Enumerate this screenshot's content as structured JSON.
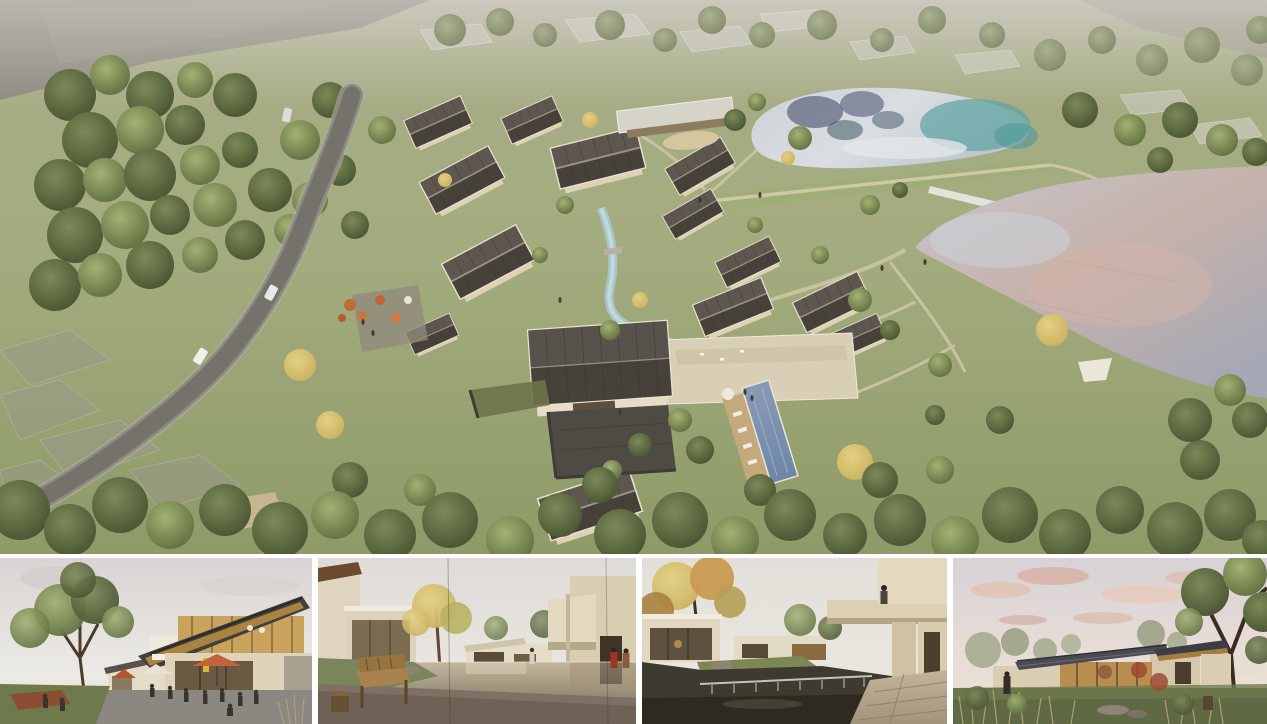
{
  "board": {
    "name": "resort-village-rendering-board",
    "background_color": "#ffffff",
    "gutter_color": "#ffffff"
  },
  "hero": {
    "name": "aerial-masterplan-render",
    "description": "Aerial view of a lakeside village resort: cluster of pitched-roof villas around a stream and stone courtyard, swimming pool with timber deck, winding access road through woodland on the left, upper pond with teal reflections and large lower lake with pink dusk reflections on the right, ghosted context buildings at the top",
    "colors": {
      "grass": "#a3ac7e",
      "grass_dark": "#8e9a68",
      "tree_dark": "#46512f",
      "tree_mid": "#5c6b3c",
      "tree_autumn": "#c9b05c",
      "road": "#74726a",
      "roof": "#474239",
      "wall": "#e3dac2",
      "courtyard_stone": "#4e4b45",
      "pool": "#6d86a6",
      "deck": "#c4a97c",
      "upper_lake": "#ccd1d6",
      "lake_teal": "#5fa3a3",
      "lake_reflection_navy": "#3a3f63",
      "lower_lake_mauve": "#c6b2ab",
      "lower_lake_silver": "#c5c6cd",
      "berm_grass": "#9fae76",
      "path": "#cfc7a8",
      "haze": "#b3afa5"
    }
  },
  "thumbnails": [
    {
      "name": "plaza-cafe-render",
      "description": "Evening plaza with cafe terraces, orange umbrellas and people below a two-storey building with a slanted timber roof; large tree and lawn on the left"
    },
    {
      "name": "courtyard-pond-render",
      "description": "Reflecting pond courtyard seen past a wooden bench and stump stool, golden tree and glass villas on the left, beige cantilevered volumes and two figures in red on the right"
    },
    {
      "name": "waterfall-pond-render",
      "description": "Dark pond spilling over a waterfall weir, autumn tree and glass pavilion at left, cantilevered beige balcony with a figure above a stone terrace at right"
    },
    {
      "name": "dusk-pavilion-render",
      "description": "Single-storey glass pavilion with a low slate roof and warm interior at dusk, pink clouds, large tree at right, meadow grasses and rocks in the foreground"
    }
  ]
}
